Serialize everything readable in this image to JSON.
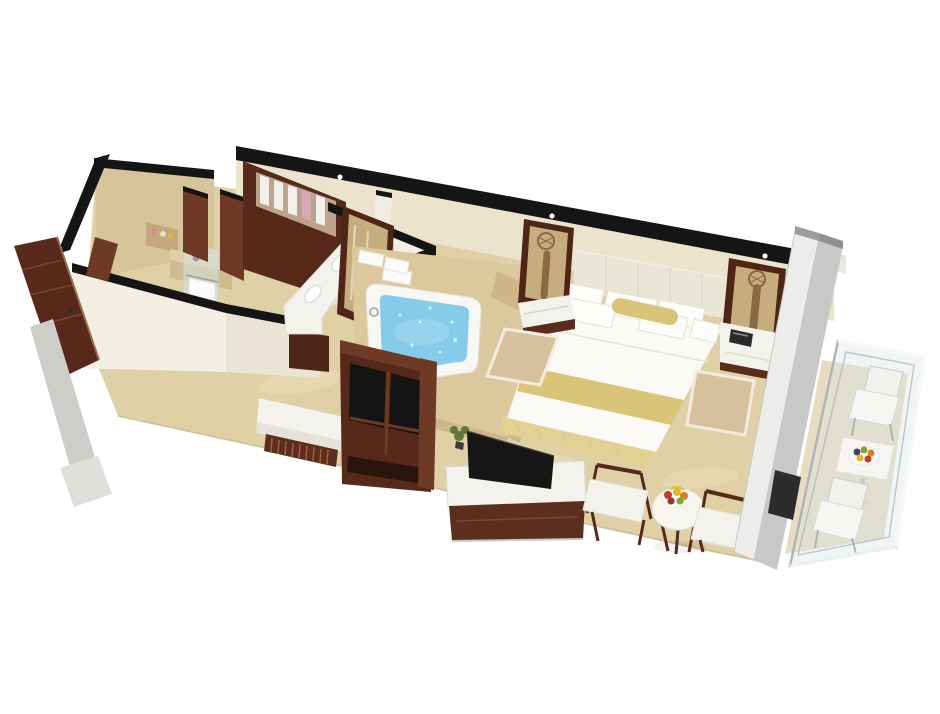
{
  "meta": {
    "type": "3d-floor-plan-rendering",
    "subject": "Hotel suite cutaway floor plan: entry, walk-in shower bathroom, wardrobe and double vanity corridor, whirlpool tub, king bedroom, sitting corner and furnished balcony",
    "canvas": {
      "width": 940,
      "height": 714
    }
  },
  "palette": {
    "background": "#ffffff",
    "wall_top": "#151515",
    "wall_cream": "#ece3cd",
    "wall_white": "#f3efe4",
    "wall_white_shade": "#e9e4d4",
    "marble_wall": "#d8c49a",
    "marble_niche": "#c2a87c",
    "floor": "#e0d0a6",
    "floor_edge": "#c9b88d",
    "balcony_floor": "#e6dcc2",
    "platform": "#dcc89d",
    "platform_side": "#cdb789",
    "wood_face": "#57291b",
    "wood_dark": "#4f2718",
    "wood_mid": "#6e3a26",
    "white_furniture": "#f4f2ec",
    "white_soft": "#e4e2da",
    "water": "#86cbe9",
    "water_light": "#aadcf2",
    "gold": "#d9c478",
    "gold_pale": "#e3d193",
    "headboard": "#e9e6d5",
    "rug": "#d6c19c",
    "glass_tint": "#d7e4e6",
    "mirror_glass": "#c6ad7e",
    "silver": "#b0b3b5",
    "panel_white": "#ececea",
    "panel_gray": "#c7c9c8",
    "tv": "#161616",
    "plant": "#5d7a3a",
    "phone": "#2b2b2b",
    "bronze": "#8a6a42",
    "fruit_red": "#c93a28",
    "fruit_yellow": "#e4b52b",
    "fruit_orange": "#d97e23",
    "fruit_green": "#7fa832",
    "fruit_purple": "#4a3f63"
  },
  "scene": {
    "rooms": [
      {
        "id": "bathroom",
        "label": "Bathroom with walk-in marble shower"
      },
      {
        "id": "dressing-corridor",
        "label": "Corridor with open wardrobe and double-sink vanity"
      },
      {
        "id": "jacuzzi-area",
        "label": "Whirlpool tub on marble platform"
      },
      {
        "id": "bedroom",
        "label": "Bedroom with king bed and sitting corner"
      },
      {
        "id": "balcony",
        "label": "Glass-railed balcony with outdoor furniture"
      }
    ],
    "objects": [
      {
        "id": "entry-door",
        "label": "Open wooden entry door"
      },
      {
        "id": "door-threshold",
        "label": "Entry threshold steps"
      },
      {
        "id": "shower-niche",
        "label": "Shower niche with toiletries"
      },
      {
        "id": "shower-bench",
        "label": "Marble shower bench"
      },
      {
        "id": "shower-glass-door",
        "label": "Glass shower door with hanging towel"
      },
      {
        "id": "wardrobe",
        "label": "Open wardrobe with hanging shirts"
      },
      {
        "id": "vanity",
        "label": "Double-sink vanity counter"
      },
      {
        "id": "vanity-mirror",
        "label": "Leaning wood-framed mirror"
      },
      {
        "id": "jacuzzi-tub",
        "label": "Whirlpool tub with blue water"
      },
      {
        "id": "bath-towels",
        "label": "Folded bath towels"
      },
      {
        "id": "bath-headrest",
        "label": "Bath pillow"
      },
      {
        "id": "luggage-bench",
        "label": "Upholstered slatted bench"
      },
      {
        "id": "minibar-cabinet",
        "label": "Dark wood cabinet with smoked glass doors"
      },
      {
        "id": "tv-console",
        "label": "Marble-top TV console"
      },
      {
        "id": "television",
        "label": "Flat-screen television"
      },
      {
        "id": "plant",
        "label": "Small green plant"
      },
      {
        "id": "bed",
        "label": "King bed with gold runner and bolster"
      },
      {
        "id": "headboard",
        "label": "Panelled upholstered headboard"
      },
      {
        "id": "nightstand-left",
        "label": "Left nightstand with mirror lamp"
      },
      {
        "id": "nightstand-right",
        "label": "Right nightstand with telephone"
      },
      {
        "id": "telephone",
        "label": "Telephone"
      },
      {
        "id": "rug-left",
        "label": "Bedside rug (left)"
      },
      {
        "id": "rug-right",
        "label": "Bedside rug (right)"
      },
      {
        "id": "armchair-left",
        "label": "Armchair"
      },
      {
        "id": "armchair-right",
        "label": "Armchair"
      },
      {
        "id": "coffee-table",
        "label": "Round table with fruit plate"
      },
      {
        "id": "fruit-plate",
        "label": "Fruit plate"
      },
      {
        "id": "ceiling-downlights",
        "label": "Downlights on wall top"
      },
      {
        "id": "sliding-door",
        "label": "Sliding glass balcony door"
      },
      {
        "id": "glass-railing",
        "label": "Glass balcony railing"
      },
      {
        "id": "balcony-table",
        "label": "Outdoor table with fruit bowl"
      },
      {
        "id": "balcony-chair-upper",
        "label": "Outdoor chair"
      },
      {
        "id": "balcony-chair-lower",
        "label": "Outdoor chair"
      }
    ]
  }
}
